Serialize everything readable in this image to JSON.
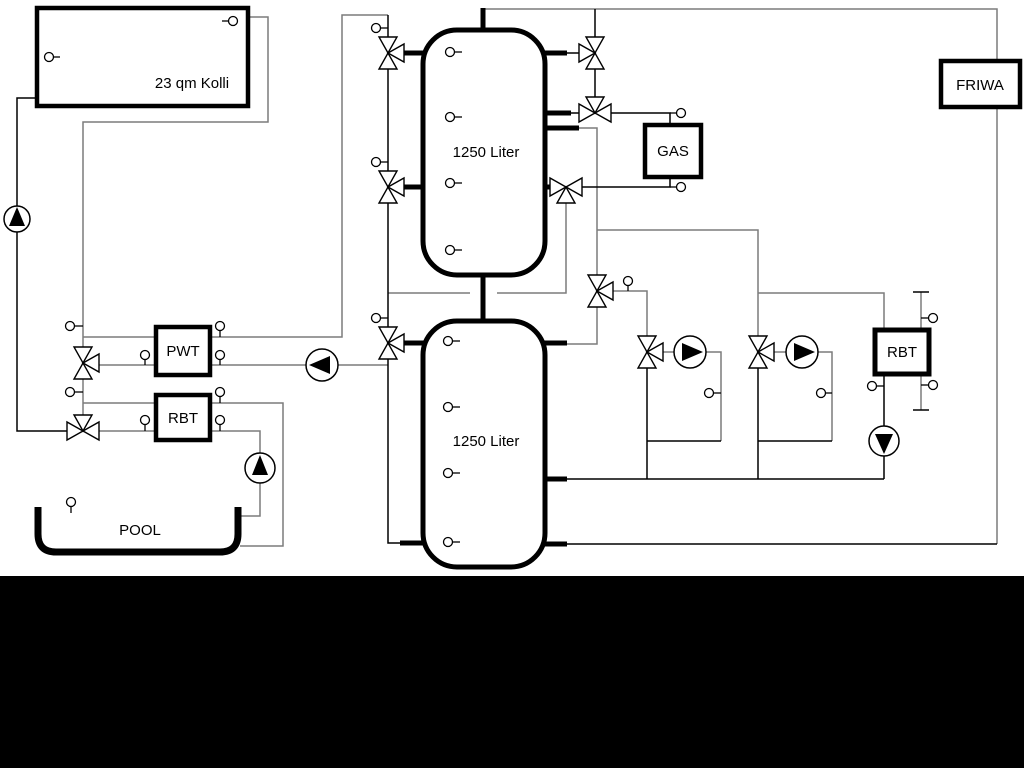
{
  "diagram": {
    "title_hint": "hydraulic heating scheme",
    "labels": {
      "collector": "23 qm Kolli",
      "tank_top": "1250 Liter",
      "tank_bottom": "1250 Liter",
      "gas": "GAS",
      "friwa": "FRIWA",
      "pwt": "PWT",
      "rbt_left": "RBT",
      "rbt_right": "RBT",
      "pool": "POOL"
    },
    "colors": {
      "pipe_gray": "#7c7c7c",
      "pipe_black": "#000000",
      "vessel_stroke": "#000000",
      "band": "#000000",
      "background": "#ffffff"
    }
  }
}
